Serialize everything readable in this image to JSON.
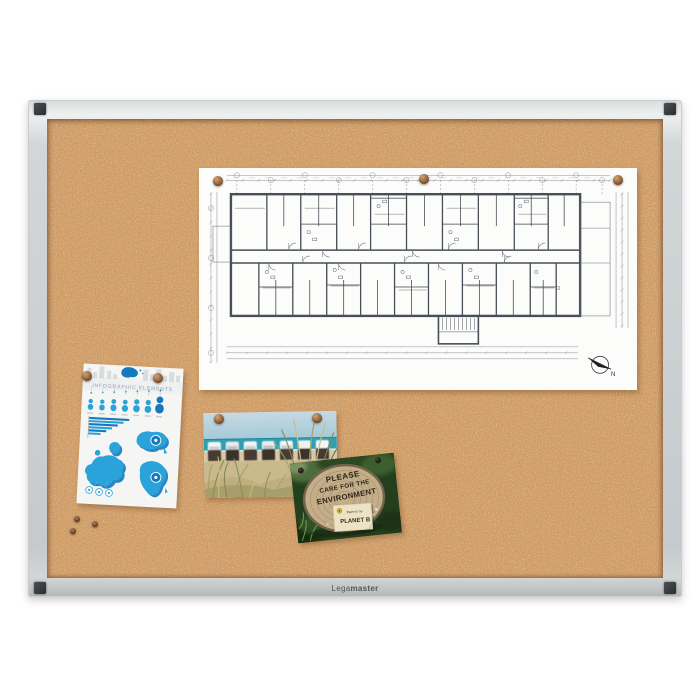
{
  "board": {
    "brand_light": "Lega",
    "brand_bold": "master",
    "frame_color": "#d6d9da",
    "corner_cap_color": "#3a3d40",
    "cork_base_color": "#d4a06a"
  },
  "floor_plan": {
    "kind": "architectural-floor-plan",
    "north_label": "N",
    "pin_count": 3
  },
  "infographic": {
    "title": "INFOGRAPHIC ELEMENTS",
    "accent_color": "#2aa2da",
    "dark_accent_color": "#1579bd",
    "bar_widths_pct": [
      100,
      86,
      72,
      58,
      44,
      30
    ],
    "people_sizes": [
      11,
      11,
      12,
      12,
      13,
      13,
      17
    ],
    "pin_count": 2
  },
  "beach_postcard": {
    "kind": "beach-photo-with-hooded-beach-chairs",
    "pin_count": 2
  },
  "environment_card": {
    "heading_line1": "PLEASE",
    "heading_line2": "CARE FOR THE",
    "heading_line3": "ENVIRONMENT",
    "note_line1": "there is no",
    "note_line2": "PLANET B"
  },
  "loose_pin_count": 3
}
